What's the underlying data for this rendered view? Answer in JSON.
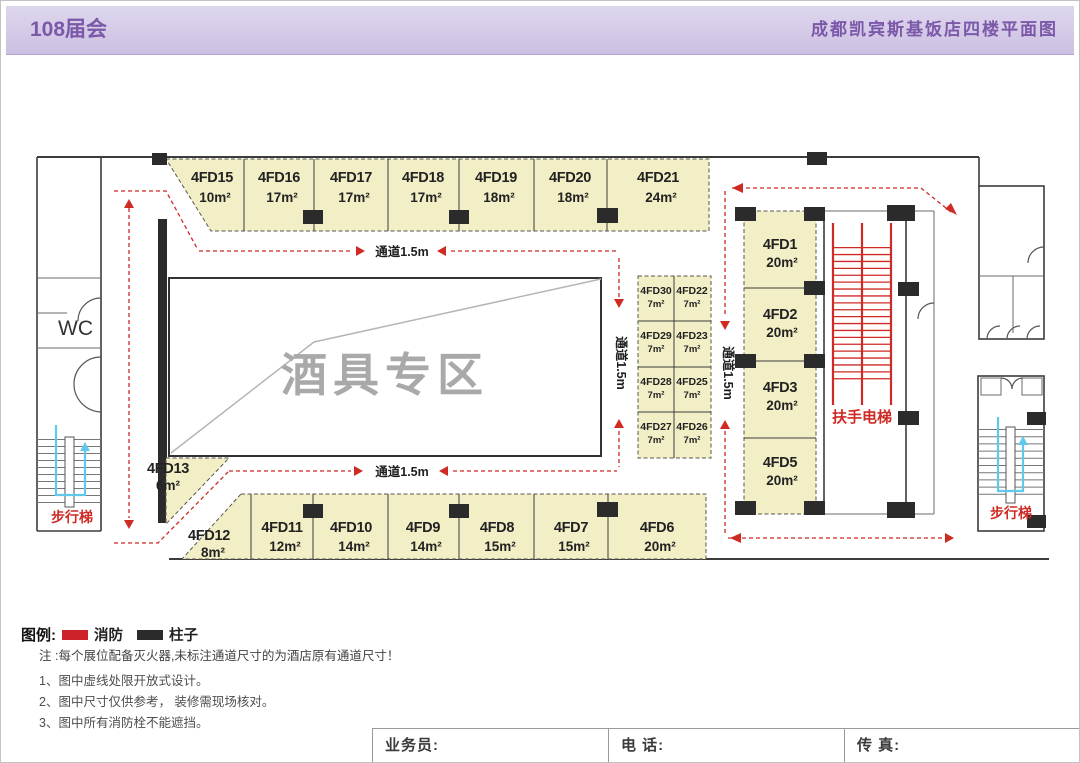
{
  "header": {
    "title_left": "108届会",
    "title_right": "成都凯宾斯基饭店四楼平面图"
  },
  "plan": {
    "zone_label": "酒具专区",
    "wc_label": "WC",
    "escalator_label": "扶手电梯",
    "stairs_left_label": "步行梯",
    "stairs_right_label": "步行梯",
    "aisle_top": "通道1.5m",
    "aisle_bottom": "通道1.5m",
    "aisle_mid": "通道1.5m",
    "aisle_right": "通道1.5m",
    "booths_top": [
      {
        "id": "4FD15",
        "area": "10m²"
      },
      {
        "id": "4FD16",
        "area": "17m²"
      },
      {
        "id": "4FD17",
        "area": "17m²"
      },
      {
        "id": "4FD18",
        "area": "17m²"
      },
      {
        "id": "4FD19",
        "area": "18m²"
      },
      {
        "id": "4FD20",
        "area": "18m²"
      },
      {
        "id": "4FD21",
        "area": "24m²"
      }
    ],
    "booths_right": [
      {
        "id": "4FD1",
        "area": "20m²"
      },
      {
        "id": "4FD2",
        "area": "20m²"
      },
      {
        "id": "4FD3",
        "area": "20m²"
      },
      {
        "id": "4FD5",
        "area": "20m²"
      }
    ],
    "booths_small": [
      {
        "id": "4FD30",
        "area": "7m²"
      },
      {
        "id": "4FD22",
        "area": "7m²"
      },
      {
        "id": "4FD29",
        "area": "7m²"
      },
      {
        "id": "4FD23",
        "area": "7m²"
      },
      {
        "id": "4FD28",
        "area": "7m²"
      },
      {
        "id": "4FD25",
        "area": "7m²"
      },
      {
        "id": "4FD27",
        "area": "7m²"
      },
      {
        "id": "4FD26",
        "area": "7m²"
      }
    ],
    "booths_bottom": [
      {
        "id": "4FD12",
        "area": "8m²"
      },
      {
        "id": "4FD11",
        "area": "12m²"
      },
      {
        "id": "4FD10",
        "area": "14m²"
      },
      {
        "id": "4FD9",
        "area": "14m²"
      },
      {
        "id": "4FD8",
        "area": "15m²"
      },
      {
        "id": "4FD7",
        "area": "15m²"
      },
      {
        "id": "4FD6",
        "area": "20m²"
      }
    ],
    "booth_13": {
      "id": "4FD13",
      "area": "6m²"
    }
  },
  "legend": {
    "title": "图例:",
    "fire": "消防",
    "pillar": "柱子"
  },
  "notes": {
    "line0": "注 :每个展位配备灭火器,未标注通道尺寸的为酒店原有通道尺寸！",
    "line1": "1、图中虚线处限开放式设计。",
    "line2": "2、图中尺寸仅供参考， 装修需现场核对。",
    "line3": "3、图中所有消防栓不能遮挡。"
  },
  "footer": {
    "salesperson": "业务员:",
    "phone": "电 话:",
    "fax": "传 真:"
  },
  "colors": {
    "accent_purple": "#7b58a8",
    "booth_fill": "#f2efc6",
    "route_red": "#cf2a24",
    "stairs_blue": "#5fc8ec",
    "pillar_black": "#2b2b2b"
  }
}
